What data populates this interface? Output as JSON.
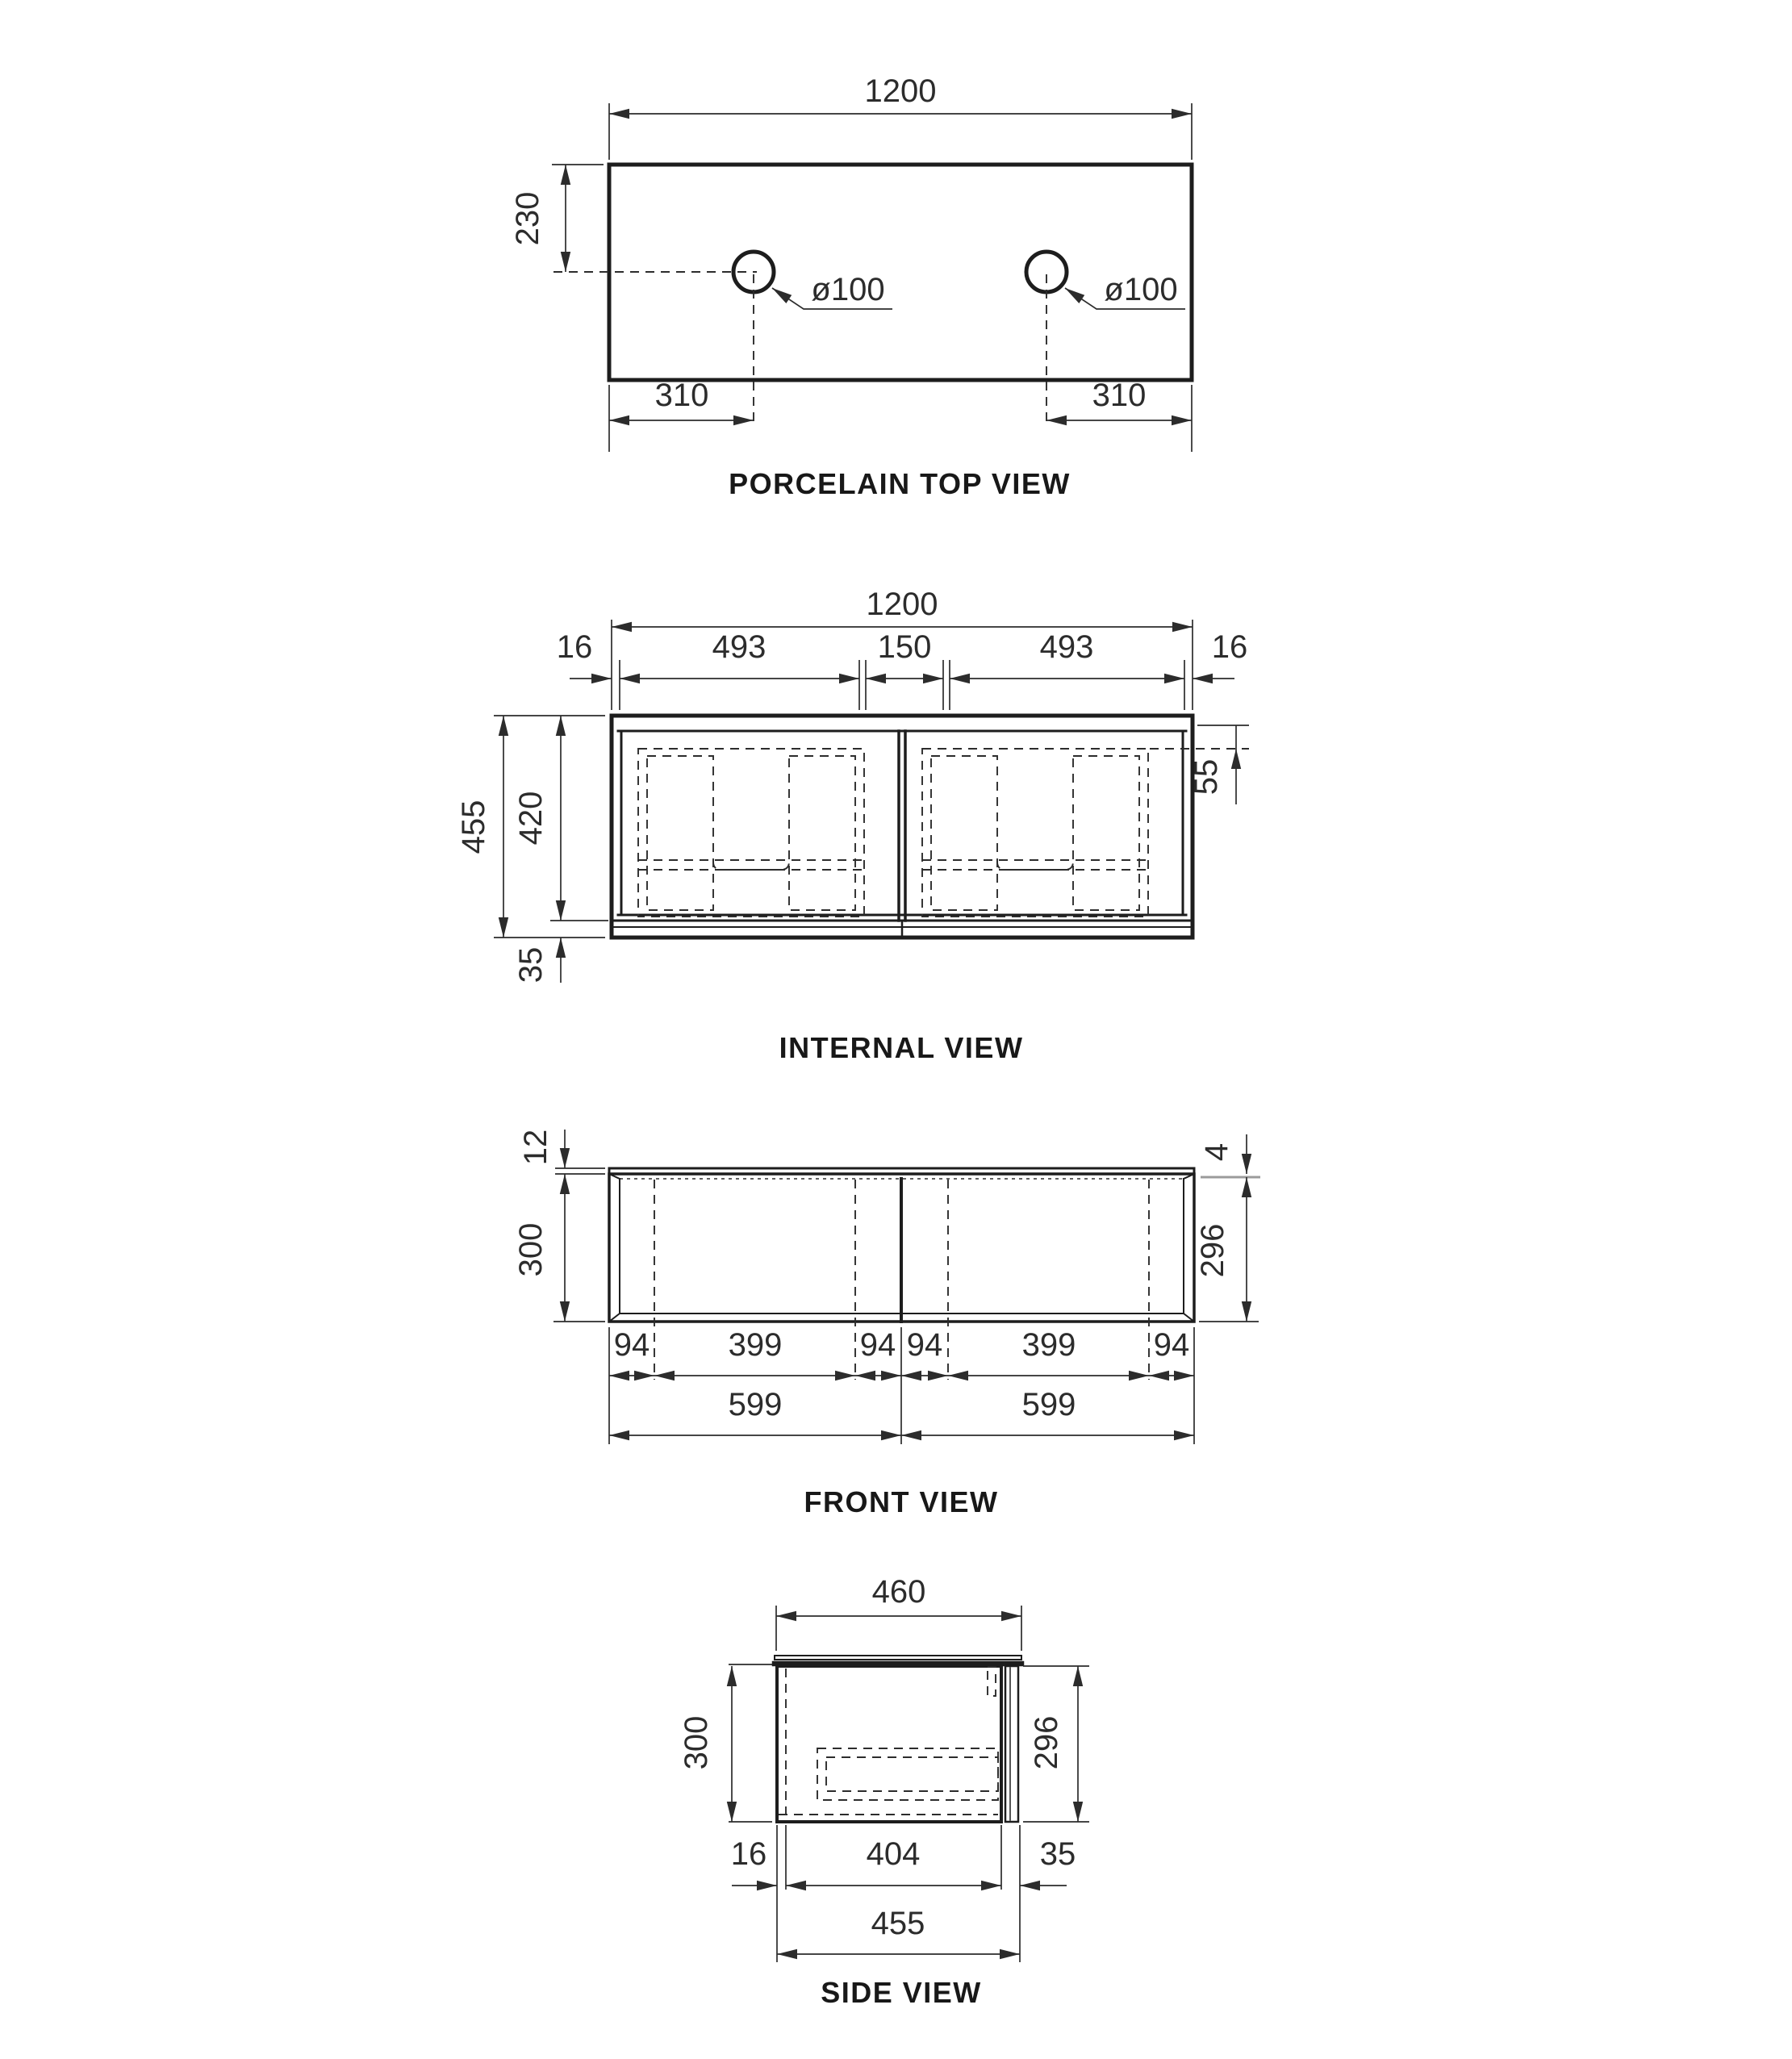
{
  "sheet": {
    "background": "#ffffff",
    "object_line_color": "#1d1d1d",
    "dimension_color": "#2c2c2c",
    "muted_line_color": "#9b9b9b"
  },
  "top_view": {
    "title": "PORCELAIN TOP VIEW",
    "overall_width": "1200",
    "hole_offset_front": "230",
    "hole_offset_left": "310",
    "hole_offset_right": "310",
    "hole_diameter_left": "ø100",
    "hole_diameter_right": "ø100"
  },
  "internal_view": {
    "title": "INTERNAL VIEW",
    "overall_width": "1200",
    "side_panel_left": "16",
    "bay_width_left": "493",
    "center_gap": "150",
    "bay_width_right": "493",
    "side_panel_right": "16",
    "overall_height": "455",
    "door_height": "420",
    "bottom_rail": "35",
    "top_offset": "55"
  },
  "front_view": {
    "title": "FRONT VIEW",
    "top_thickness": "12",
    "top_reveal": "4",
    "carcass_height": "300",
    "door_height": "296",
    "segments": [
      "94",
      "399",
      "94",
      "94",
      "399",
      "94"
    ],
    "door_width_left": "599",
    "door_width_right": "599"
  },
  "side_view": {
    "title": "SIDE VIEW",
    "top_depth": "460",
    "carcass_height": "300",
    "door_height": "296",
    "back_panel": "16",
    "internal_depth": "404",
    "door_assembly": "35",
    "overall_depth": "455"
  }
}
